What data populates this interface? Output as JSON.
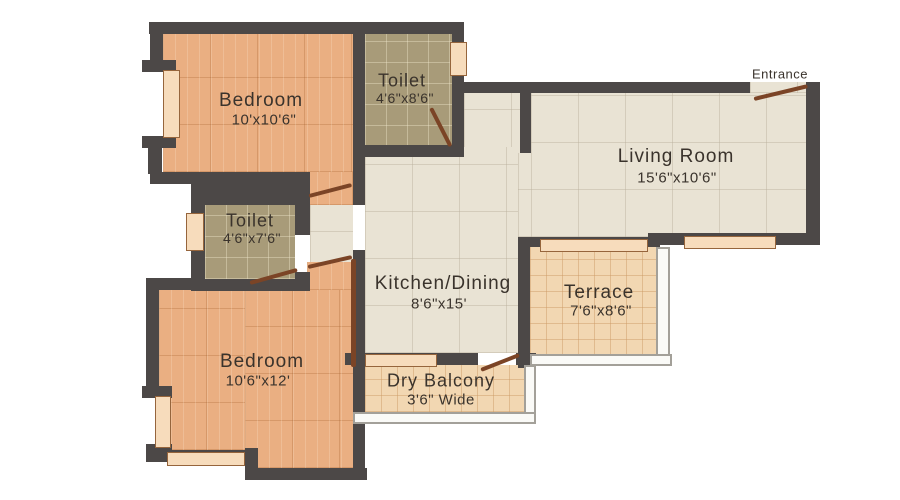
{
  "rooms": {
    "bedroom1": {
      "name": "Bedroom",
      "dims": "10'x10'6\""
    },
    "toilet1": {
      "name": "Toilet",
      "dims": "4'6\"x8'6\""
    },
    "living": {
      "name": "Living Room",
      "dims": "15'6\"x10'6\""
    },
    "toilet2": {
      "name": "Toilet",
      "dims": "4'6\"x7'6\""
    },
    "kitchen": {
      "name": "Kitchen/Dining",
      "dims": "8'6\"x15'"
    },
    "terrace": {
      "name": "Terrace",
      "dims": "7'6\"x8'6\""
    },
    "bedroom2": {
      "name": "Bedroom",
      "dims": "10'6\"x12'"
    },
    "dry_balcony": {
      "name": "Dry Balcony",
      "dims": "3'6\" Wide"
    }
  },
  "annotations": {
    "entrance": "Entrance"
  },
  "colors": {
    "wall": "#4c4847",
    "bedroom_floor": "#eaaf82",
    "toilet_floor": "#a89b79",
    "living_floor": "#e9e3d4",
    "terrace_floor": "#f2d7b2",
    "window": "#f7dcbc",
    "door": "#7b4426",
    "balcony_rail": "#a3a099",
    "text": "#3a332c",
    "background": "#ffffff"
  }
}
